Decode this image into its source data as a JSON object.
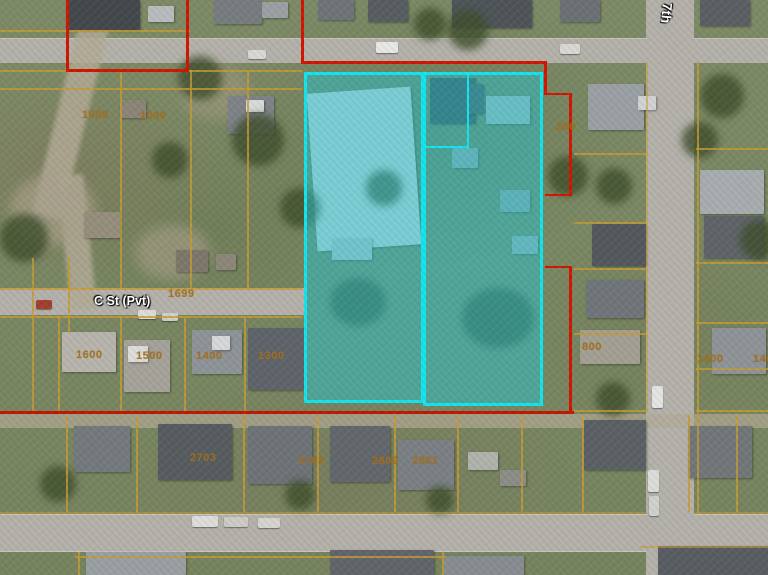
{
  "map_title": "aerial-parcel-selection-map",
  "labels": {
    "street": [
      {
        "text": "C St (Pvt)",
        "x": 94,
        "y": 294,
        "rot": 0,
        "size": 12.5
      },
      {
        "text": "S 7th",
        "x": 676,
        "y": -9,
        "rot": 95,
        "size": 13.5
      }
    ],
    "parcel": [
      {
        "text": "1000",
        "x": 82,
        "y": 109
      },
      {
        "text": "1000",
        "x": 140,
        "y": 110
      },
      {
        "text": "1699",
        "x": 168,
        "y": 288
      },
      {
        "text": "1600",
        "x": 76,
        "y": 349
      },
      {
        "text": "1500",
        "x": 136,
        "y": 350
      },
      {
        "text": "1400",
        "x": 196,
        "y": 350
      },
      {
        "text": "1300",
        "x": 258,
        "y": 350
      },
      {
        "text": "200",
        "x": 556,
        "y": 121
      },
      {
        "text": "800",
        "x": 582,
        "y": 341
      },
      {
        "text": "1400",
        "x": 697,
        "y": 353
      },
      {
        "text": "1400",
        "x": 753,
        "y": 353
      },
      {
        "text": "2703",
        "x": 190,
        "y": 452
      },
      {
        "text": "2701",
        "x": 298,
        "y": 455
      },
      {
        "text": "2802",
        "x": 372,
        "y": 455
      },
      {
        "text": "2801",
        "x": 412,
        "y": 455
      }
    ]
  },
  "colors": {
    "selection_fill": "rgba(40,195,208,0.5)",
    "selection_border": "#12e4ee",
    "boundary_red": "#d11500",
    "parcel_line_yellow": "#c79a35",
    "parcel_label_orange": "#a1701e",
    "street_label_white": "#ffffff"
  }
}
